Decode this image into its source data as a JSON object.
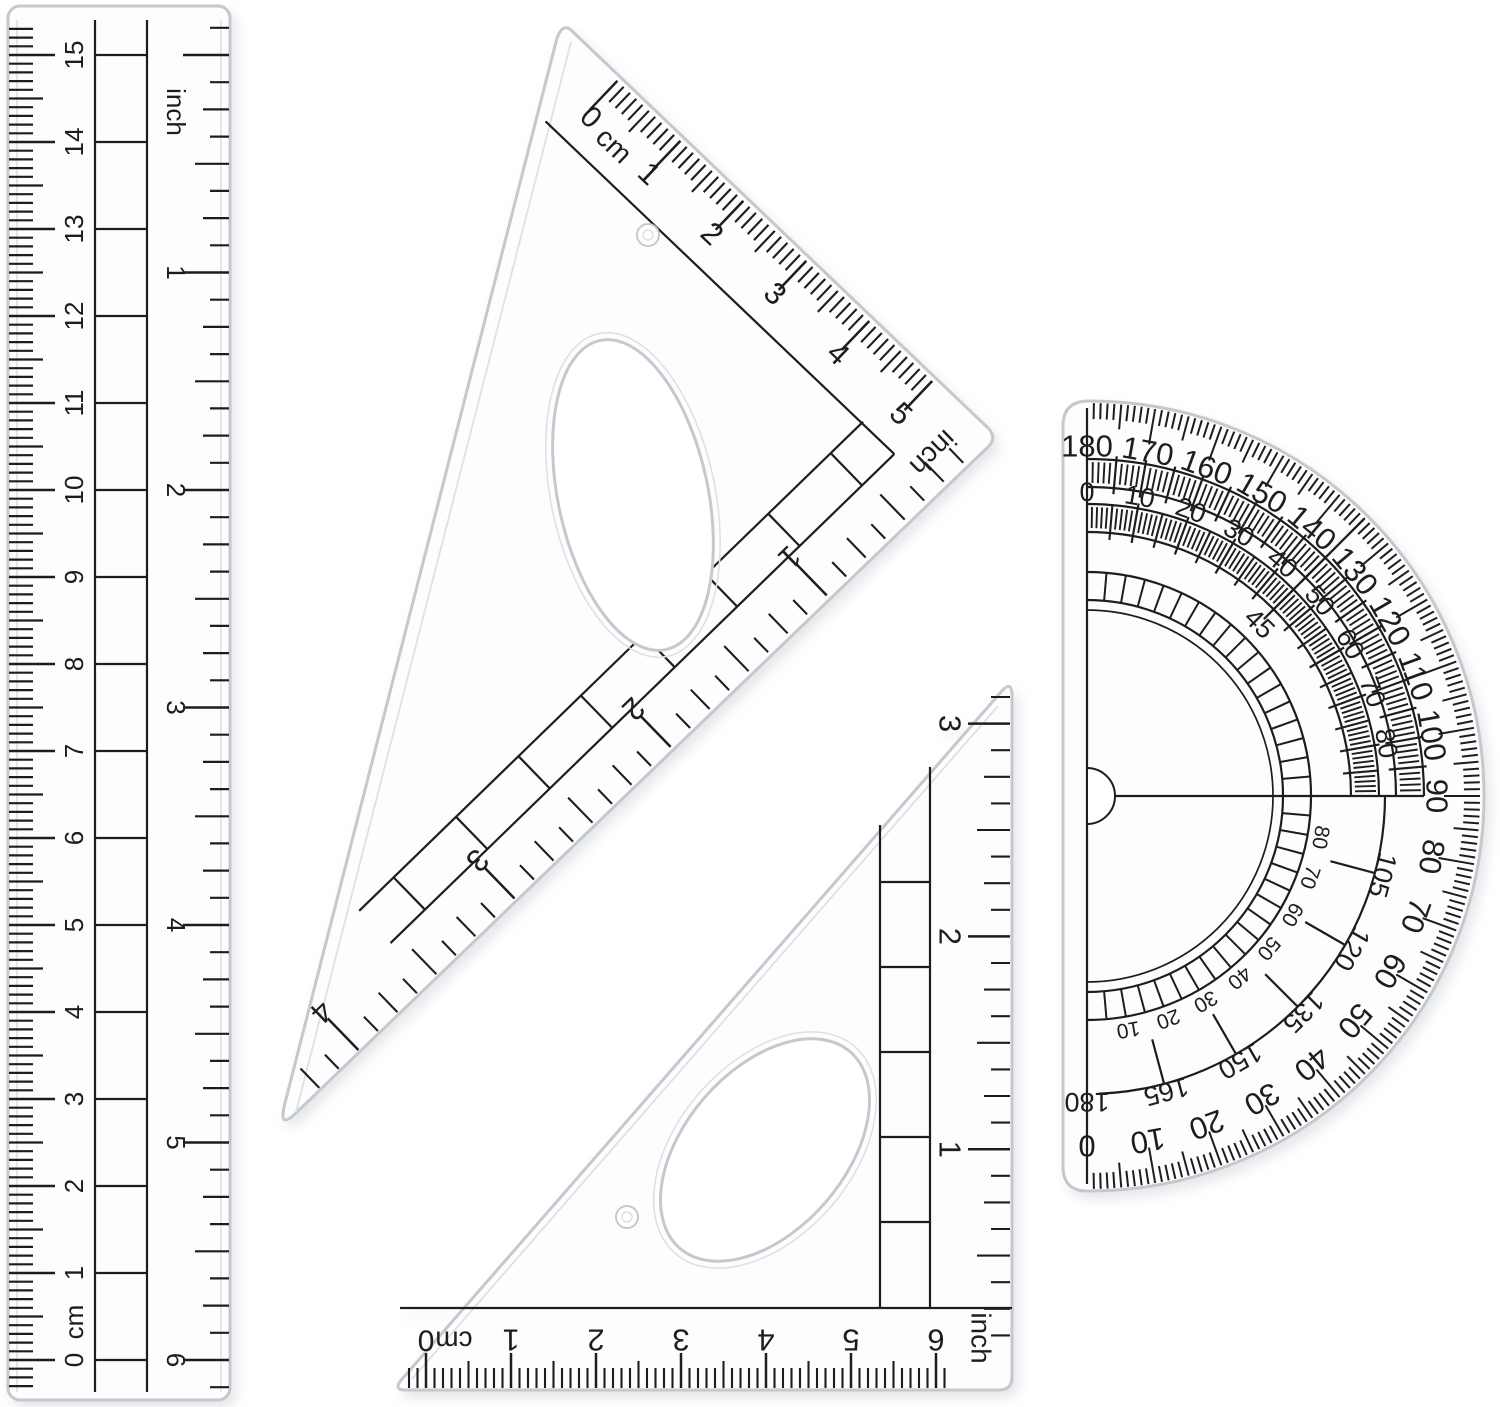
{
  "scene": {
    "ink": "#1d1d1d",
    "plastic_edge": "#c3c9cf",
    "plastic_fill": "#fdfdfe",
    "bevel": "#dde1e5",
    "background": "#ffffff"
  },
  "ruler": {
    "cm_zero_label": "0",
    "cm_unit_label": "cm",
    "cm_numbers": [
      "1",
      "2",
      "3",
      "4",
      "5",
      "6",
      "7",
      "8",
      "9",
      "10",
      "11",
      "12",
      "13",
      "14",
      "15"
    ],
    "inch_label": "inch",
    "inch_numbers": [
      "1",
      "2",
      "3",
      "4",
      "5",
      "6"
    ]
  },
  "triangle_large": {
    "cm_zero_label": "0",
    "cm_unit_label": "cm",
    "cm_numbers": [
      "1",
      "2",
      "3",
      "4",
      "5"
    ],
    "inch_label": "inch",
    "inch_numbers": [
      "1",
      "2",
      "3",
      "4"
    ]
  },
  "triangle_small": {
    "cm_zero_label": "0",
    "cm_unit_label": "cm",
    "cm_numbers": [
      "1",
      "2",
      "3",
      "4",
      "5",
      "6"
    ],
    "inch_label": "inch",
    "inch_numbers": [
      "1",
      "2",
      "3"
    ]
  },
  "protractor": {
    "outer_labels": [
      "180",
      "170",
      "160",
      "150",
      "140",
      "130",
      "120",
      "110",
      "100",
      "90",
      "80",
      "70",
      "60",
      "50",
      "40",
      "30",
      "20",
      "10",
      "0"
    ],
    "middle_top_labels": [
      "0",
      "10",
      "20",
      "30",
      "40",
      "50",
      "60",
      "70",
      "80"
    ],
    "middle_bottom_labels": [
      "105",
      "120",
      "135",
      "150",
      "165",
      "180"
    ],
    "inner_labels": [
      "80",
      "70",
      "60",
      "50",
      "40",
      "30",
      "20",
      "10"
    ],
    "quadrant_label": "45"
  }
}
